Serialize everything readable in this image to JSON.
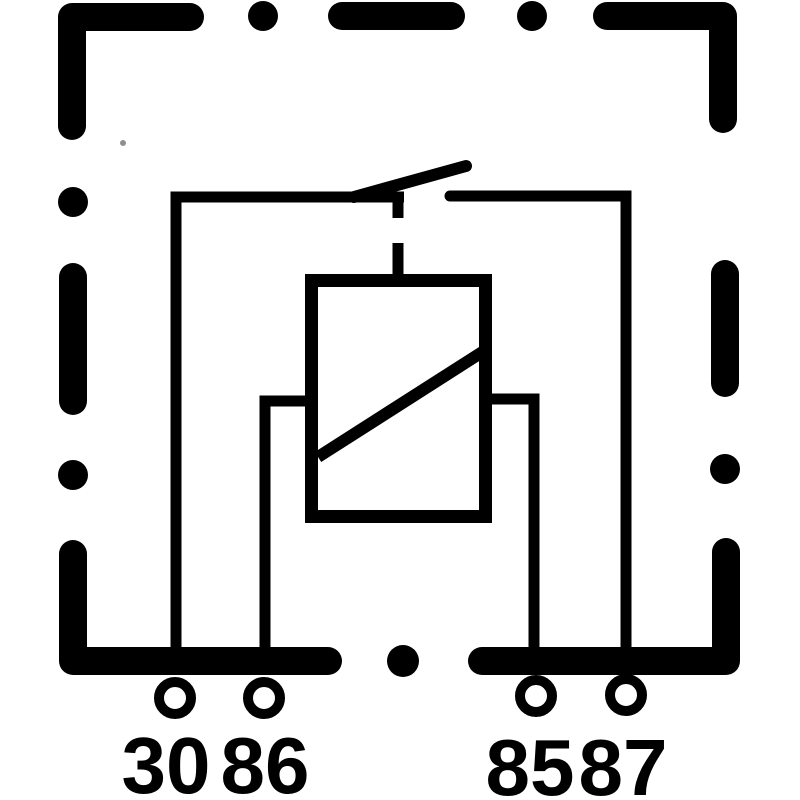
{
  "diagram": {
    "background_color": "#ffffff",
    "line_color": "#000000",
    "artifact_color": "#8f8f8f",
    "terminals": [
      {
        "label": "30"
      },
      {
        "label": "86"
      },
      {
        "label": "85"
      },
      {
        "label": "87"
      }
    ]
  }
}
